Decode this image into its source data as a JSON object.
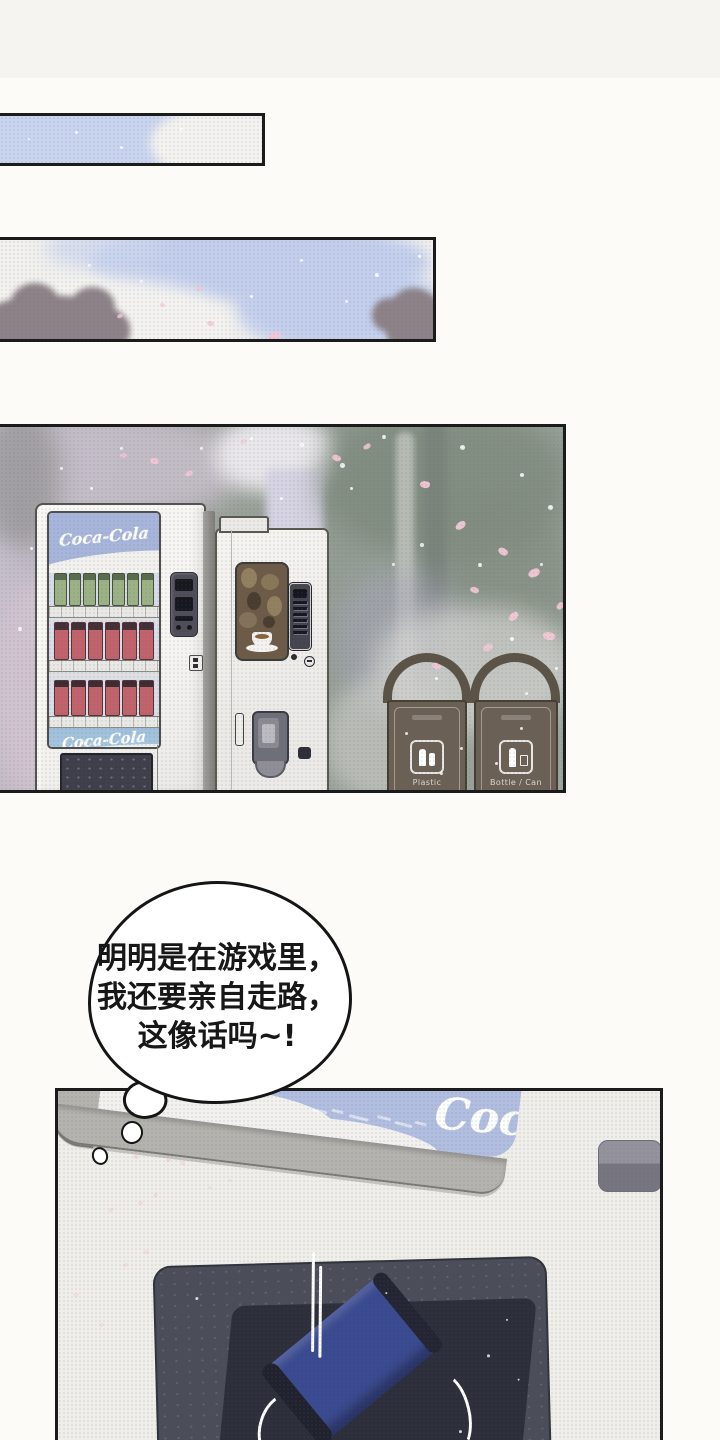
{
  "speech_bubble": {
    "lines": [
      "明明是在游戏里，",
      "我还要亲自走路，",
      "这像话吗~!"
    ]
  },
  "scene": {
    "coke_machine": {
      "logo_top": "Coca-Cola",
      "logo_bottom": "Coca-Cola"
    },
    "bins": {
      "bin1_label": "Plastic",
      "bin2_label": "Bottle / Can"
    }
  },
  "closeup": {
    "partial_logo": "Coca"
  },
  "colors": {
    "sky_blue": "#c6d1ec",
    "panel_border": "#1b1b1b",
    "machine_body": "#f4f3ef",
    "coke_ad_top": "#a8b5da",
    "coke_ad_bottom": "#a5c3dd",
    "bin_brown": "#6b6054",
    "flap_dark": "#4b4d58",
    "can_blue": "#3a4a90",
    "ad_strip_blue": "#b2bee0",
    "petal_pink": "#f3c8d6"
  },
  "decor": {
    "sky1_bokeh": [
      [
        75,
        15,
        3
      ],
      [
        120,
        30,
        3
      ],
      [
        28,
        22,
        2
      ],
      [
        180,
        12,
        3
      ]
    ],
    "sky2_petals": [
      [
        195,
        46,
        7,
        5,
        15,
        0.8
      ],
      [
        117,
        74,
        6,
        4,
        -20,
        0.8
      ],
      [
        207,
        81,
        7,
        5,
        25,
        0.85
      ],
      [
        268,
        92,
        13,
        9,
        -10,
        0.9
      ],
      [
        160,
        63,
        5,
        4,
        30,
        0.7
      ]
    ],
    "sky2_bokeh": [
      [
        375,
        33,
        4
      ],
      [
        418,
        15,
        3
      ],
      [
        300,
        19,
        3
      ],
      [
        88,
        24,
        3
      ],
      [
        345,
        60,
        3
      ],
      [
        140,
        40,
        3
      ],
      [
        250,
        55,
        3
      ]
    ],
    "scene_petals": [
      [
        150,
        31,
        9,
        6,
        20,
        0.9
      ],
      [
        185,
        44,
        8,
        5,
        -15,
        0.85
      ],
      [
        332,
        28,
        9,
        6,
        30,
        0.9
      ],
      [
        363,
        17,
        8,
        5,
        -25,
        0.85
      ],
      [
        420,
        54,
        10,
        7,
        15,
        0.95
      ],
      [
        455,
        95,
        11,
        7,
        -30,
        0.95
      ],
      [
        498,
        121,
        10,
        7,
        40,
        0.95
      ],
      [
        528,
        142,
        12,
        8,
        -20,
        0.95
      ],
      [
        470,
        160,
        9,
        6,
        25,
        0.9
      ],
      [
        508,
        186,
        11,
        7,
        -35,
        0.95
      ],
      [
        543,
        205,
        12,
        8,
        20,
        0.95
      ],
      [
        483,
        217,
        10,
        7,
        -15,
        0.9
      ],
      [
        432,
        236,
        9,
        6,
        35,
        0.9
      ],
      [
        556,
        176,
        8,
        6,
        -40,
        0.9
      ],
      [
        120,
        26,
        7,
        5,
        10,
        0.7
      ],
      [
        240,
        12,
        7,
        5,
        -20,
        0.6
      ]
    ],
    "scene_bokeh": [
      [
        300,
        16,
        4
      ],
      [
        340,
        36,
        5
      ],
      [
        382,
        8,
        4
      ],
      [
        460,
        18,
        5
      ],
      [
        520,
        46,
        4
      ],
      [
        548,
        78,
        5
      ],
      [
        420,
        116,
        4
      ],
      [
        392,
        136,
        3
      ],
      [
        478,
        136,
        4
      ],
      [
        540,
        136,
        3
      ],
      [
        350,
        60,
        3
      ],
      [
        250,
        10,
        3
      ],
      [
        510,
        210,
        4
      ],
      [
        555,
        240,
        3
      ],
      [
        435,
        250,
        3
      ],
      [
        520,
        300,
        3
      ],
      [
        460,
        320,
        3
      ],
      [
        120,
        20,
        3
      ],
      [
        60,
        40,
        3
      ],
      [
        200,
        20,
        3
      ],
      [
        30,
        120,
        3
      ],
      [
        18,
        200,
        4
      ],
      [
        90,
        60,
        3
      ],
      [
        280,
        70,
        3
      ],
      [
        525,
        265,
        3
      ],
      [
        495,
        335,
        3
      ],
      [
        440,
        345,
        3
      ],
      [
        405,
        305,
        3
      ]
    ],
    "closeup_petals": [
      [
        75,
        64,
        6,
        4,
        20,
        0.5
      ],
      [
        108,
        67,
        5,
        4,
        -15,
        0.5
      ],
      [
        122,
        70,
        5,
        4,
        30,
        0.5
      ],
      [
        50,
        117,
        6,
        4,
        -20,
        0.45
      ],
      [
        80,
        110,
        5,
        4,
        15,
        0.45
      ],
      [
        95,
        102,
        5,
        4,
        -30,
        0.45
      ],
      [
        85,
        159,
        6,
        4,
        25,
        0.4
      ],
      [
        65,
        172,
        5,
        4,
        -15,
        0.4
      ],
      [
        15,
        202,
        6,
        4,
        20,
        0.35
      ],
      [
        41,
        232,
        5,
        4,
        -25,
        0.35
      ],
      [
        150,
        95,
        4,
        3,
        10,
        0.4
      ],
      [
        170,
        88,
        4,
        3,
        -10,
        0.4
      ]
    ],
    "blue_marks": [
      [
        212,
        150,
        16,
        3,
        7,
        0.7
      ],
      [
        232,
        148,
        12,
        3,
        7,
        0.7
      ],
      [
        250,
        152,
        20,
        3,
        7,
        0.75
      ],
      [
        278,
        149,
        14,
        3,
        7,
        0.7
      ],
      [
        296,
        153,
        18,
        3,
        7,
        0.75
      ],
      [
        316,
        150,
        12,
        3,
        7,
        0.7
      ]
    ],
    "flap_specks": [
      [
        40,
        30,
        3
      ],
      [
        330,
        95,
        3
      ],
      [
        360,
        120,
        2
      ],
      [
        300,
        170,
        3
      ],
      [
        65,
        180,
        2
      ],
      [
        230,
        30,
        2
      ],
      [
        350,
        60,
        2
      ]
    ]
  }
}
